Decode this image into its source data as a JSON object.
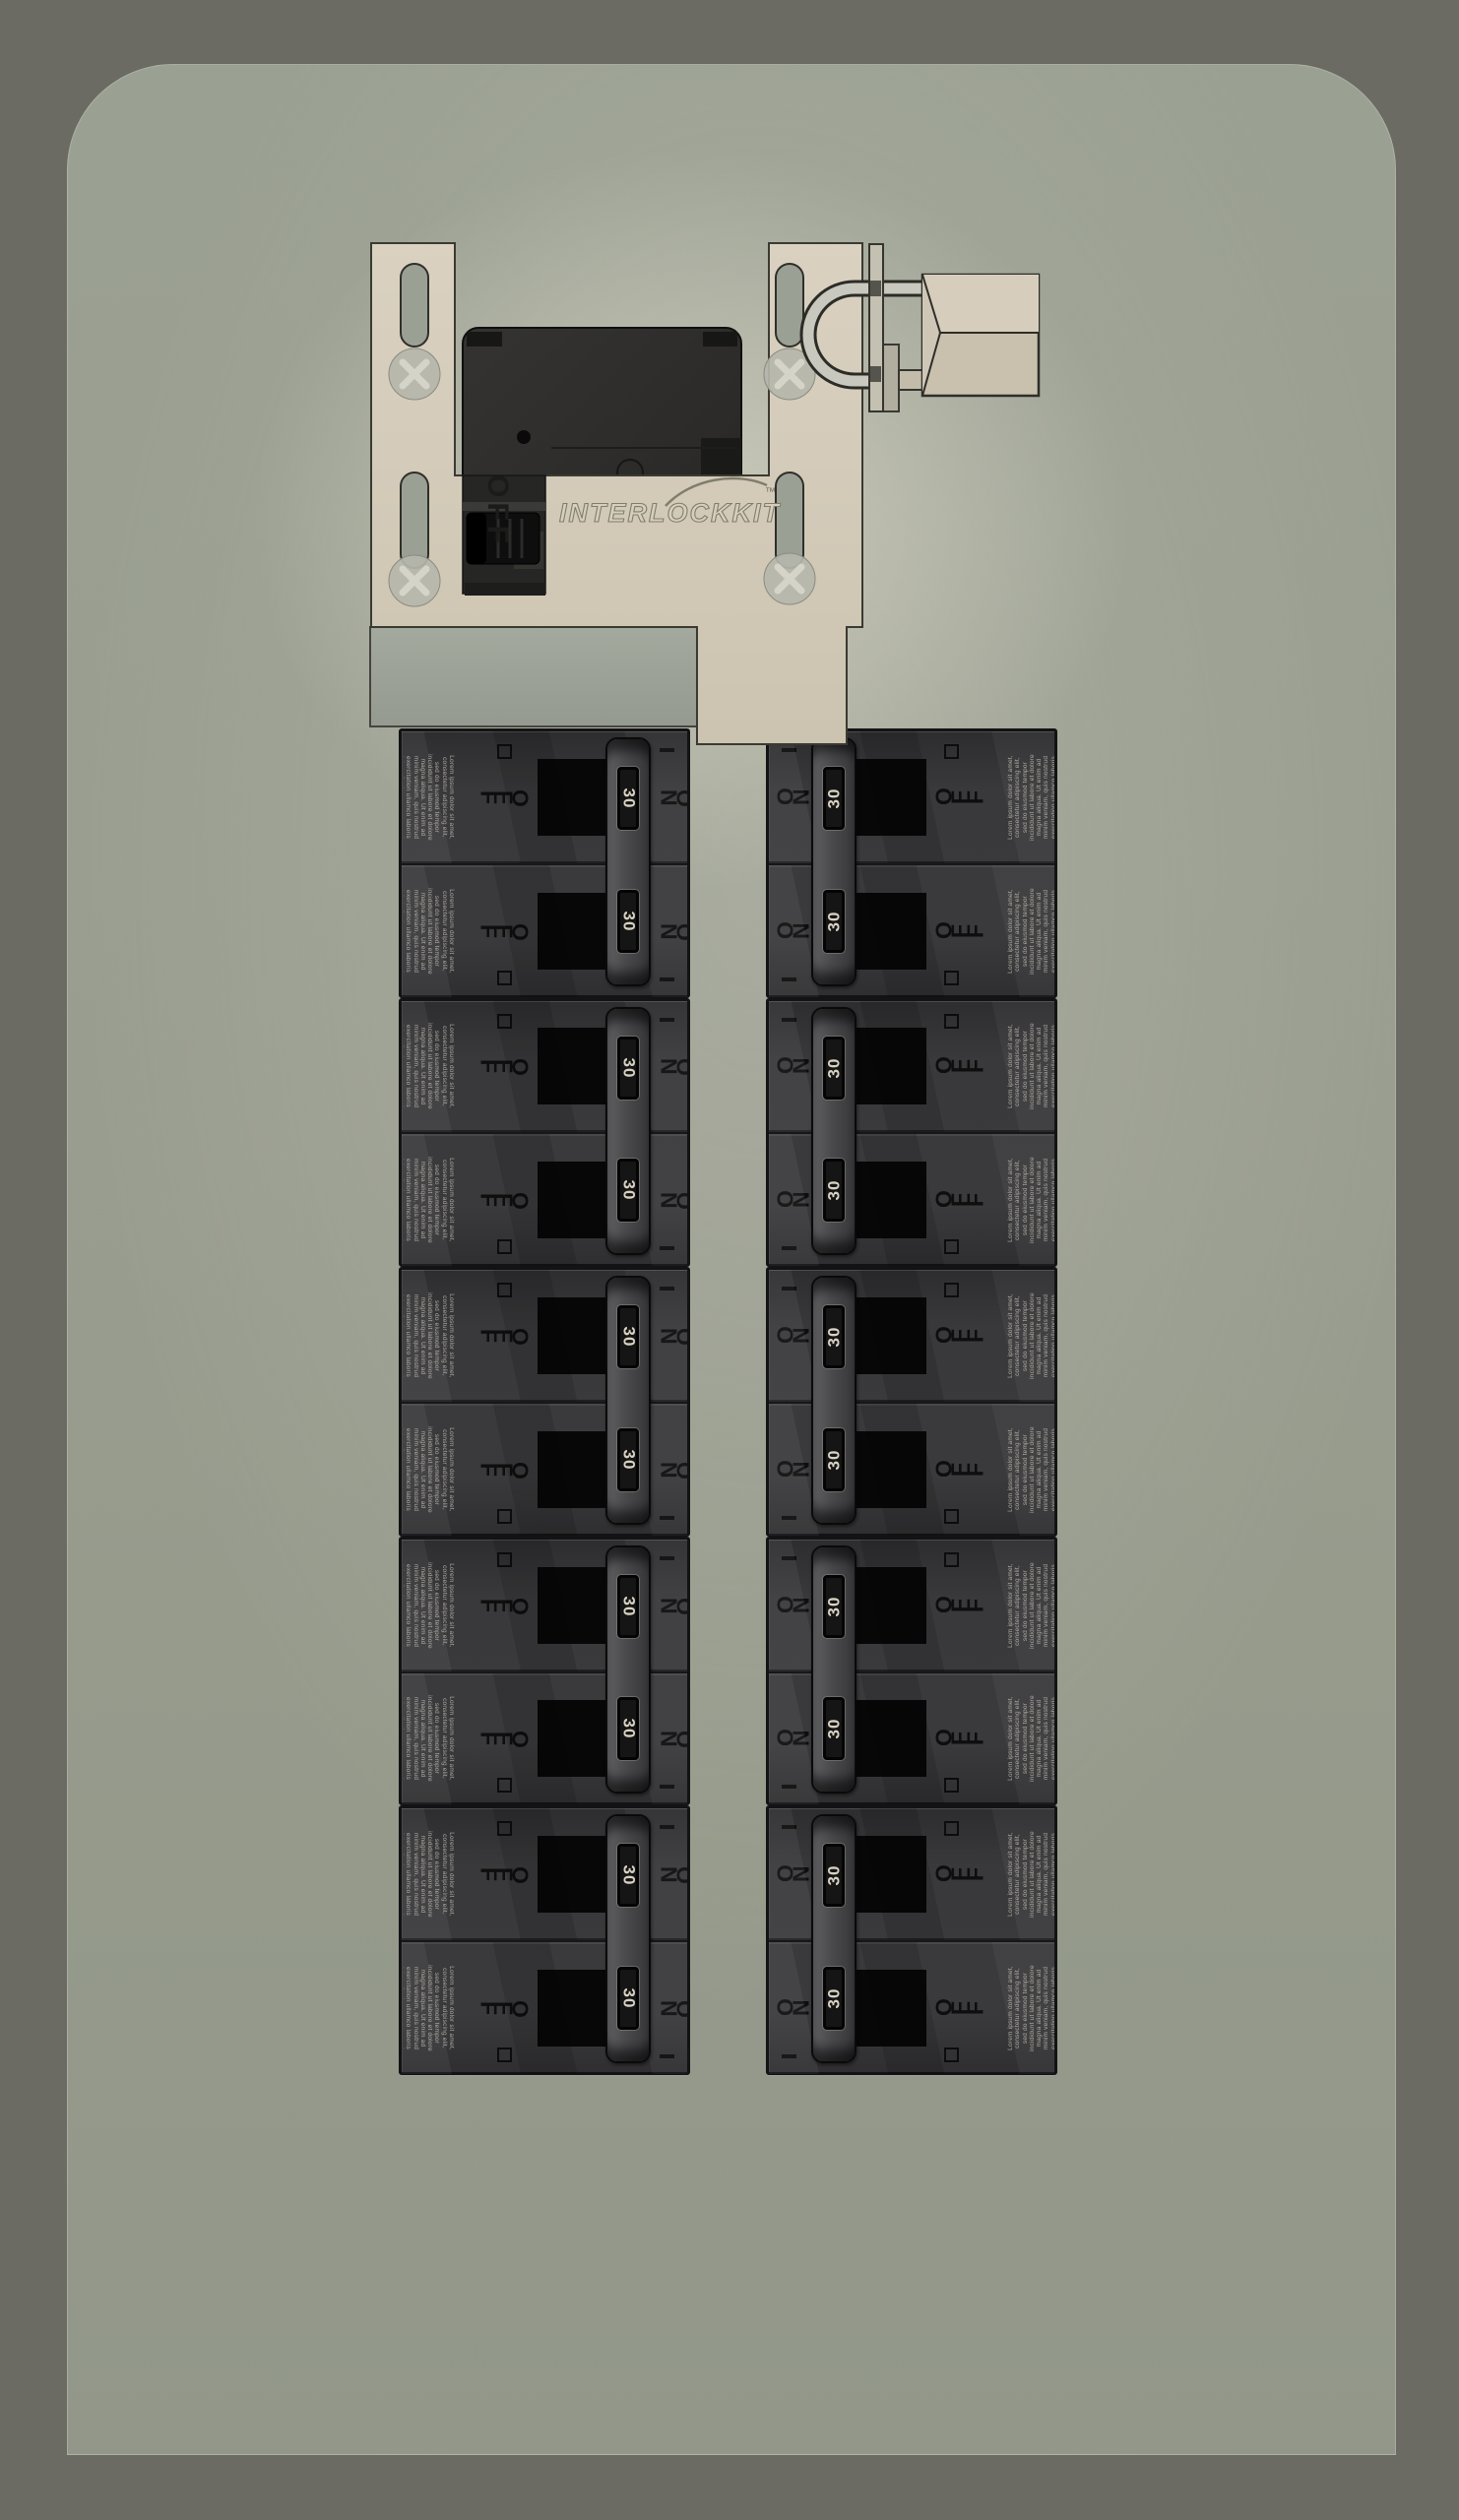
{
  "scene": {
    "description": "Generator interlock kit installed on a breaker panel, main breaker locked OFF with padlock",
    "colors": {
      "backdrop": "#6b6b63",
      "panel_face": "#9aa092",
      "bracket_plate": "#d5ccba",
      "breaker_face": "#39393b",
      "amp_label_text": "#d9d2c2"
    }
  },
  "interlock_kit": {
    "brand_logo": "INTERLOCKKIT",
    "trademark": "™",
    "main_breaker_label": "OFF"
  },
  "breakers": {
    "amp_rating": "30",
    "on_label": "ON",
    "off_label": "OFF",
    "warning_text": "Lorem ipsum dolor sit amet, consectetur adipiscing elit, sed do eiusmod tempor incididunt ut labore et dolore magna aliqua. Ut enim ad minim veniam, quis nostrud exercitation ullamco laboris nisi ut aliquip ex ea commodo consequat.",
    "left_column_units": 5,
    "right_column_units": 5,
    "poles_per_unit": 2
  }
}
